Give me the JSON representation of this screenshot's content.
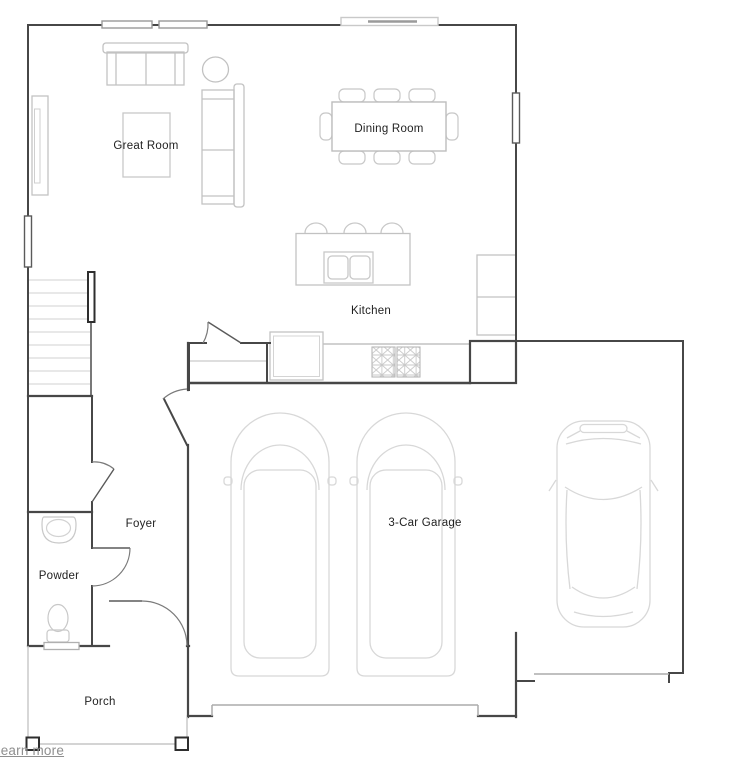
{
  "page": {
    "background": "#ffffff"
  },
  "floorplan": {
    "rooms": {
      "great_room": {
        "label": "Great Room"
      },
      "dining_room": {
        "label": "Dining Room"
      },
      "kitchen": {
        "label": "Kitchen"
      },
      "foyer": {
        "label": "Foyer"
      },
      "powder": {
        "label": "Powder"
      },
      "porch": {
        "label": "Porch"
      },
      "garage": {
        "label": "3-Car Garage"
      }
    },
    "colors": {
      "wall": "#474747",
      "furniture_line": "#c2c2c2",
      "car_line": "#d8d8d8",
      "porch_line": "#c6c6c6",
      "garage_door_line": "#ababab",
      "label_text": "#1f1f1f",
      "link_text": "#8f8f8f"
    }
  },
  "footer": {
    "learn_more_label": "Learn more"
  }
}
